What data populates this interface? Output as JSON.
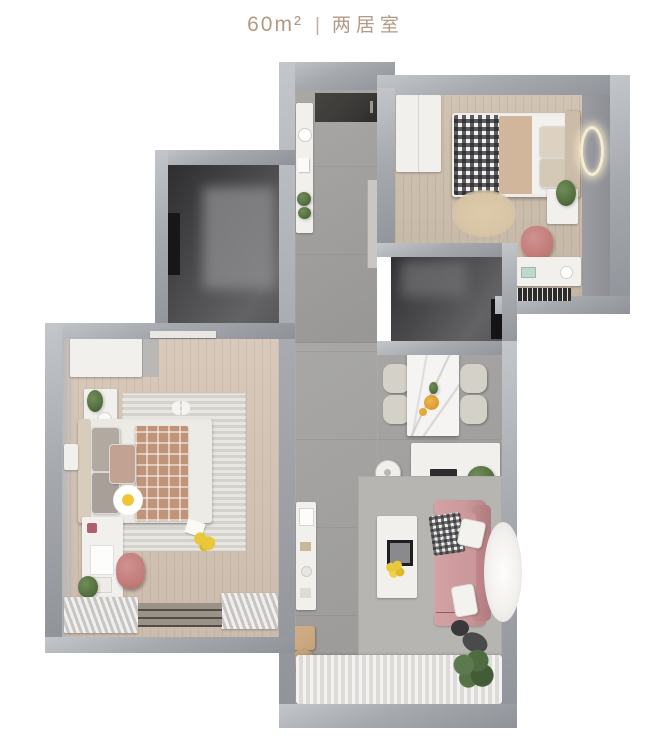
{
  "title": {
    "area": "60m²",
    "separator": "|",
    "kind": "两居室"
  },
  "colors": {
    "background": "#ffffff",
    "title_text": "#b19a87",
    "wall": "#a6a9ae",
    "wall_light": "#c3c6ca",
    "wall_dark": "#8f9298",
    "wall_face": "#9b9ca2",
    "tile": "#a3a2a0",
    "wood_warm": "#d6c6b7",
    "wood_light": "#cfc0ae",
    "rug_living": "#b7b5b1",
    "rug_bedroom": "#e0ded8",
    "rug_round_beige": "#d8c5a6",
    "dark_room": "#4a4a4c",
    "entry_mat": "#3b3a38",
    "white_furniture": "#f2f0ec",
    "sofa_pink": "#cb999b",
    "chair_pink": "#c07a76",
    "blanket_brown": "#c09478",
    "duvet_beige": "#d2b69b",
    "plant_green": "#55703f",
    "flower_yellow": "#e9c93b",
    "wood_stool": "#c5a179",
    "marble_white": "#f5f4f2"
  }
}
